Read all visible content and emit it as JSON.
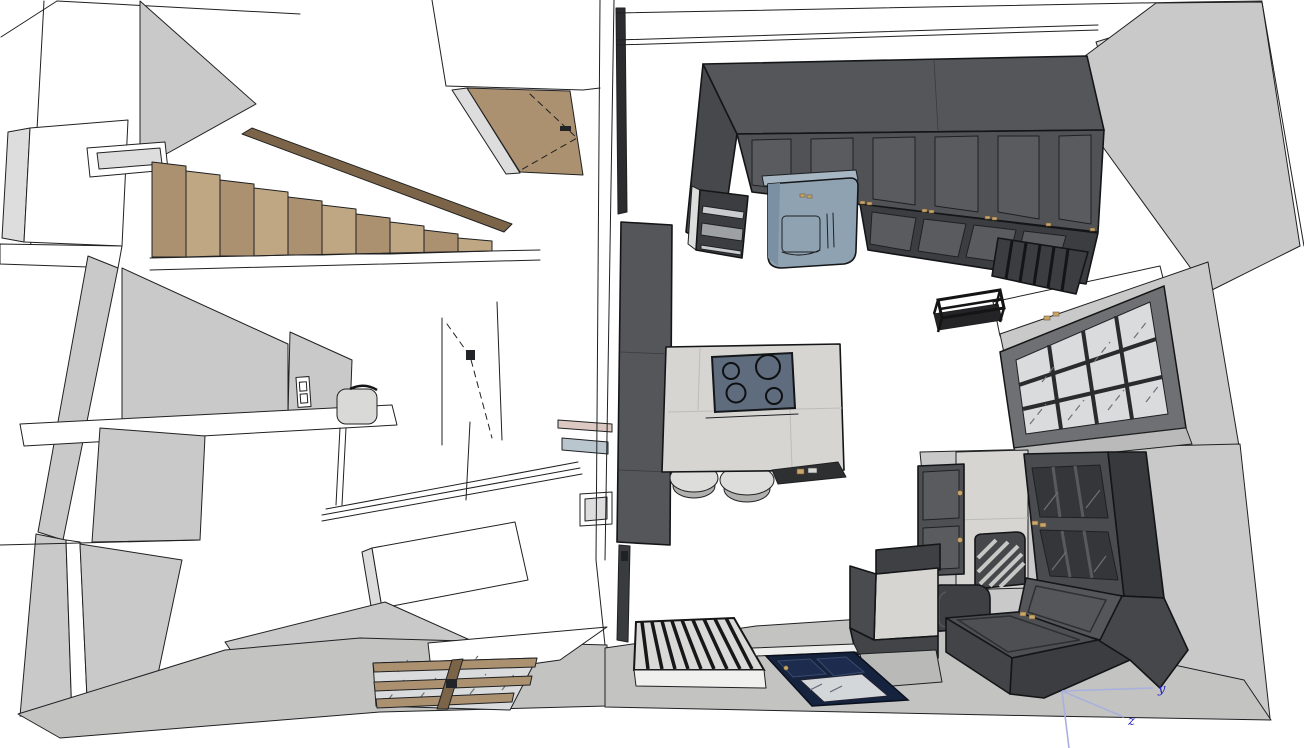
{
  "view": {
    "app_type": "3d-model-viewport",
    "description": "Overhead cutaway (top-down perspective) of a two-unit residential 3D model: left unit with wooden staircase, hallway partitions and wood-grid window; right unit with dark kitchen cabinet run, range hood, island with 4-burner cooktop and stools, pantry slab, gridded window, dark lounge furniture, slatted bench and navy entry door."
  },
  "axis_gizmo": {
    "labels": {
      "y": "y",
      "z": "z"
    },
    "origin_px": [
      1062,
      691
    ]
  },
  "palette": {
    "bg": "#ffffff",
    "white": "#ffffff",
    "wallTop": "#c9c9c9",
    "wallMid": "#dddddd",
    "floorBand": "#c3c3c2",
    "woodLight": "#bfa784",
    "woodMid": "#ab9170",
    "woodDark": "#7b6448",
    "darkCab": "#515256",
    "darkCabTop": "#55565a",
    "darkCabSide": "#47484c",
    "darkCabPanel": "#5a5b5f",
    "darkCabDeep": "#3c3d40",
    "stone": "#d6d5d2",
    "glass": "#d9dbdc",
    "glassDark": "#35363a",
    "hood": "#8fa2b2",
    "hoodDark": "#7b90a2",
    "cooktop": "#5e6c7e",
    "navy": "#16233e",
    "navyPanel": "#1d2c4e",
    "stool": "#dddddb",
    "stoolRim": "#b0b0ae",
    "brass": "#caa66a",
    "axisLine": "#a9b1dc",
    "axisText": "#2323c8",
    "edge": "#1f2022"
  },
  "scene": {
    "left_unit": {
      "objects": [
        "wooden staircase",
        "stair stringer",
        "wall niche opening",
        "corner closet volume",
        "open wooden door (plan view) with swing dashes",
        "interior partition walls",
        "light switch",
        "toilet cistern",
        "built-in white cabinetry with angled counter",
        "interior door swing dashes",
        "wood-frame floor window",
        "small wall niche",
        "shelf strips"
      ],
      "staircase_steps": 10,
      "floor_window_grid": {
        "cols": 3,
        "rows": 2
      }
    },
    "right_unit": {
      "objects": [
        "kitchen upper cabinet run (6 doors)",
        "lower door row",
        "open shelving slats",
        "wall oven stack",
        "range hood",
        "tall pantry slab",
        "kitchen island with stone top",
        "cooktop",
        "bar stools",
        "black wall shelf",
        "gridded window (dark frame)",
        "two-door upper cabinet",
        "concrete wall panel",
        "display cabinet with glass doors",
        "slatted chair",
        "storage bench with sloped lid",
        "side cabinet with stone top",
        "slatted bench (plan view)",
        "navy entry door with glass",
        "floor slab band"
      ],
      "cooktop_burners": 4,
      "bar_stools": 2,
      "window_grid": {
        "cols": 4,
        "rows": 3
      },
      "bench_slats": 9
    }
  }
}
